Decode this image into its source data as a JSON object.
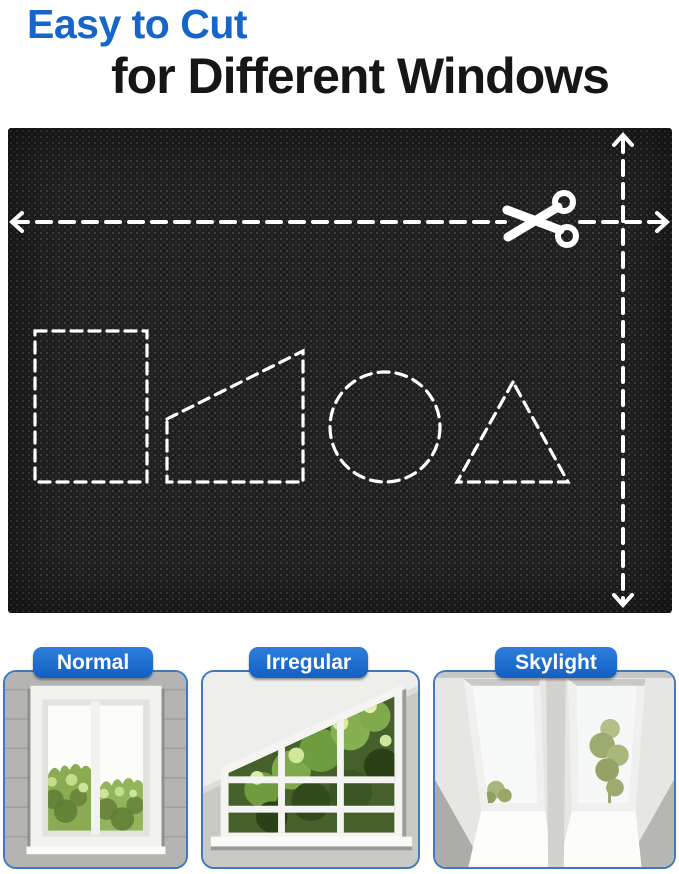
{
  "title": {
    "line1": "Easy to Cut",
    "line2": "for Different Windows"
  },
  "fabric_panel": {
    "scissors_icon": "scissors-icon",
    "cut_guides": [
      "horizontal-dashed-cut-line",
      "vertical-dashed-cut-line"
    ],
    "cut_shapes": [
      "rectangle",
      "trapezoid",
      "circle",
      "triangle"
    ]
  },
  "window_cards": [
    {
      "label": "Normal"
    },
    {
      "label": "Irregular"
    },
    {
      "label": "Skylight"
    }
  ],
  "colors": {
    "accent_blue": "#1565cb",
    "title_text": "#161616",
    "label_text": "#ffffff",
    "card_border": "#4179be",
    "fabric_base": "#1e1e1e",
    "cut_guide": "#ffffff"
  }
}
